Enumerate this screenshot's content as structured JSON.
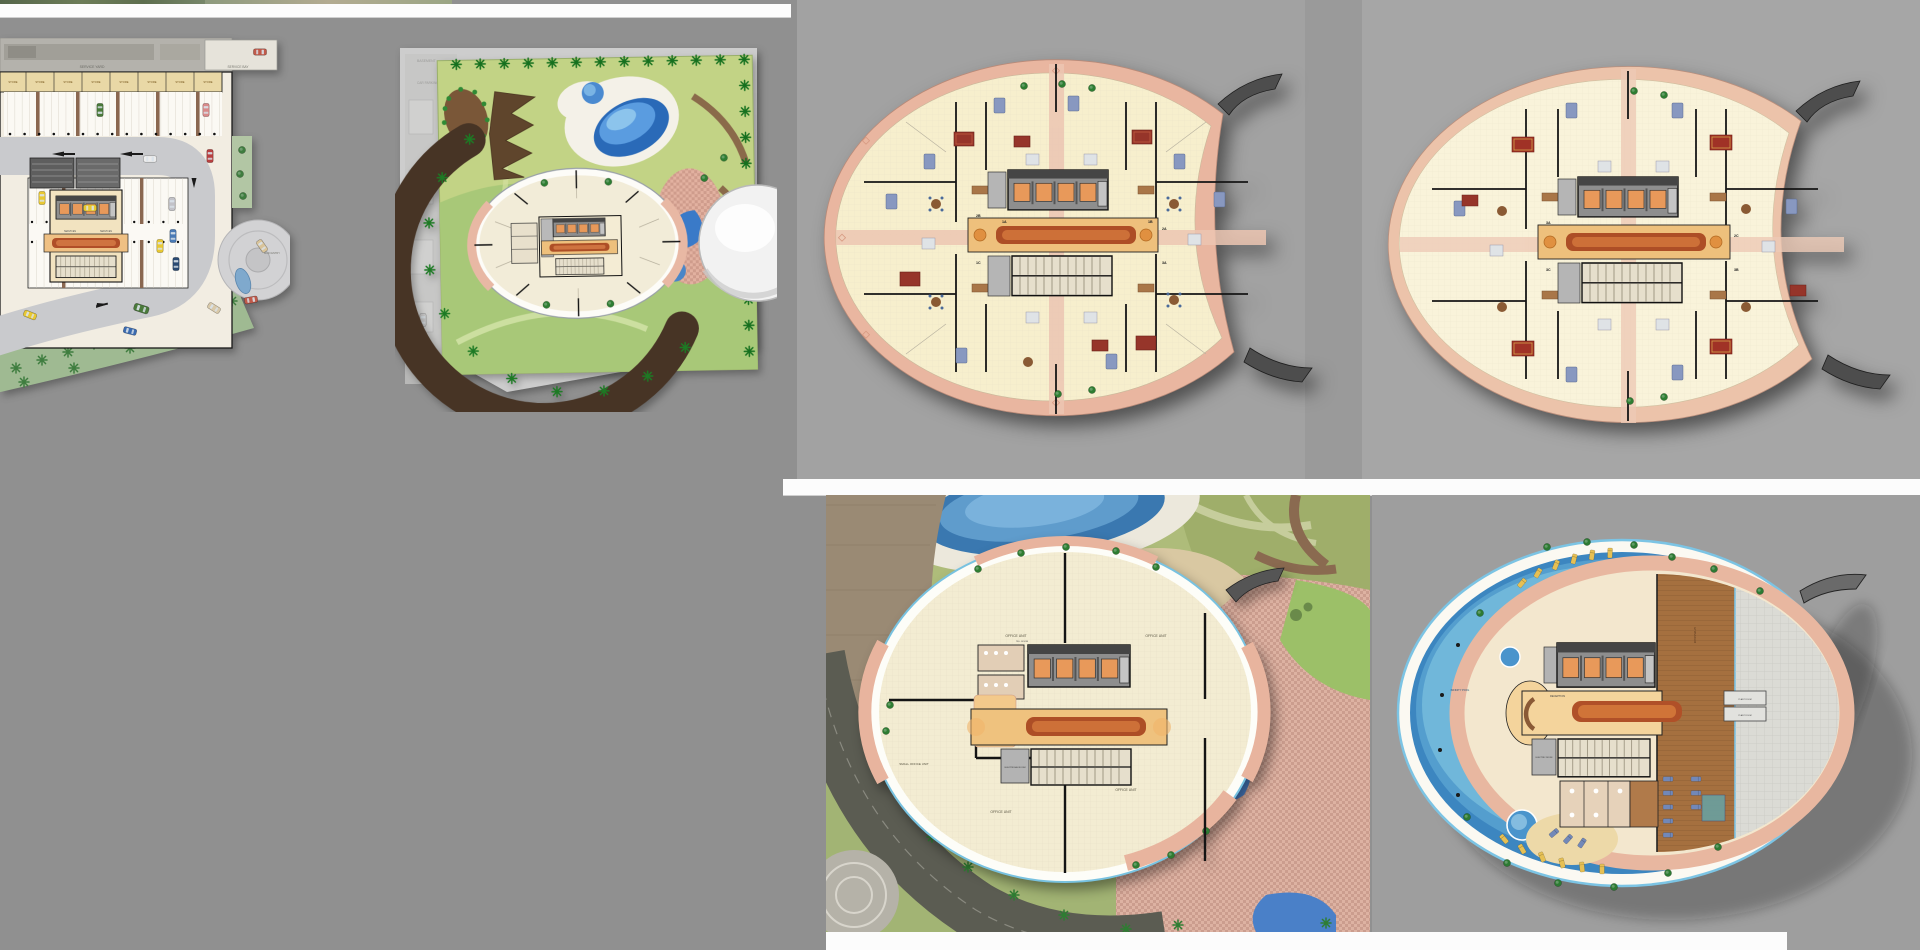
{
  "page": {
    "background": "#909090",
    "row_gap_color": "#fcfcfc"
  },
  "palette": {
    "left_background_gray": "#909090",
    "panel_gray_a": "#a2a2a2",
    "panel_gray_mid": "#9a9a9a",
    "panel_gray_b": "#a6a6a6",
    "club_panel_gray": "#9e9e9e",
    "balcony_salmon": "#e9b6a0",
    "floor_cream": "#f7efcd",
    "corridor_carpet_red": "#ad4e26",
    "elevator_cab_orange": "#e8995a",
    "pool_blue": "#3c86c0",
    "lawn_green": "#a2b474",
    "road_gray": "#c9cacd",
    "asphalt_green_gray": "#5b5c52",
    "store_beige": "#e9d8a6",
    "dark_canopy": "#4d4d4d"
  },
  "tiles": {
    "parking": {
      "labels": {
        "service_yard": "SERVICE YARD",
        "service_bay": "SERVICE BAY",
        "store": "STORE",
        "services": "SERVICES",
        "main_entry": "MAIN ENTRY"
      }
    },
    "ground": {
      "labels": {
        "basement": "BASEMENT",
        "car_parking": "CAR PARKING"
      }
    },
    "typical_a": {
      "unit_tags": [
        "2B",
        "1C",
        "1A",
        "1B",
        "2A",
        "3A"
      ]
    },
    "typical_b": {
      "unit_tags": [
        "3A",
        "3C",
        "2C",
        "3B"
      ]
    },
    "office": {
      "labels": {
        "office_unit": "OFFICE UNIT",
        "small_office_unit": "SMALL OFFICE UNIT",
        "electrical_room": "ELECTRICAL ROOM",
        "tel_room": "TEL. ROOM"
      }
    },
    "club": {
      "labels": {
        "reception": "RECEPTION",
        "gymnasium": "GYMNASIUM",
        "plant_room": "PLANT ROOM",
        "infinity_pool": "INFINITY POOL",
        "electric_room": "ELECTRIC ROOM"
      }
    }
  }
}
